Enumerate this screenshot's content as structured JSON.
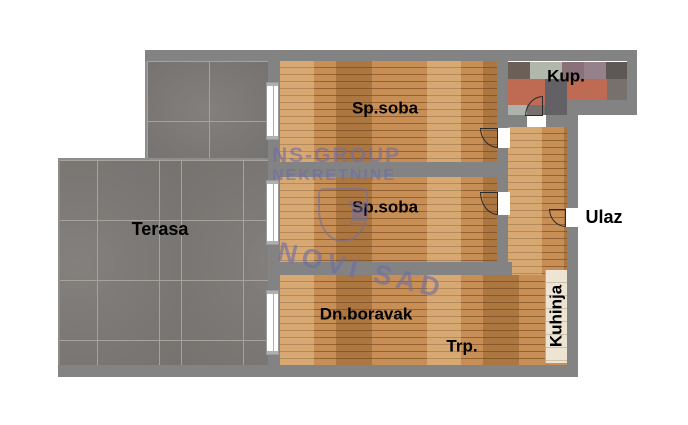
{
  "rooms": {
    "terasa": "Terasa",
    "sp_soba_1": "Sp.soba",
    "sp_soba_2": "Sp.soba",
    "dn_boravak": "Dn.boravak",
    "trpezarija": "Trp.",
    "kuhinja": "Kuhinja",
    "kupatilo": "Kup.",
    "ulaz": "Ulaz"
  },
  "watermark": {
    "company": "NS-GROUP",
    "business": "NEKRETNINE",
    "city": "NOVI SAD"
  },
  "icons": {
    "castle": "♜"
  },
  "colors": {
    "wall": "#838383",
    "wood_base": "#c78e55",
    "terrace_tile": "#7c7977",
    "terrace_grout": "#a6a39d",
    "kitchen_tile": "#ede4d3",
    "kitchen_line": "#cdc3ac",
    "bath_salmon": "#bf6a52",
    "bath_sage": "#b2b7ab",
    "bath_slate": "#636066",
    "bath_mauve": "#8a7078",
    "bath_mauve2": "#96818a",
    "bath_dark": "#5d5856",
    "bath_darkbrown": "#6b5f58",
    "bath_gray": "#77706d",
    "bath_light": "#adb3ab",
    "watermark": "#6e6ea5",
    "door_line": "#2a2a2a",
    "window_frame": "#9a9a9a",
    "window_tick": "#b0b0b0"
  }
}
